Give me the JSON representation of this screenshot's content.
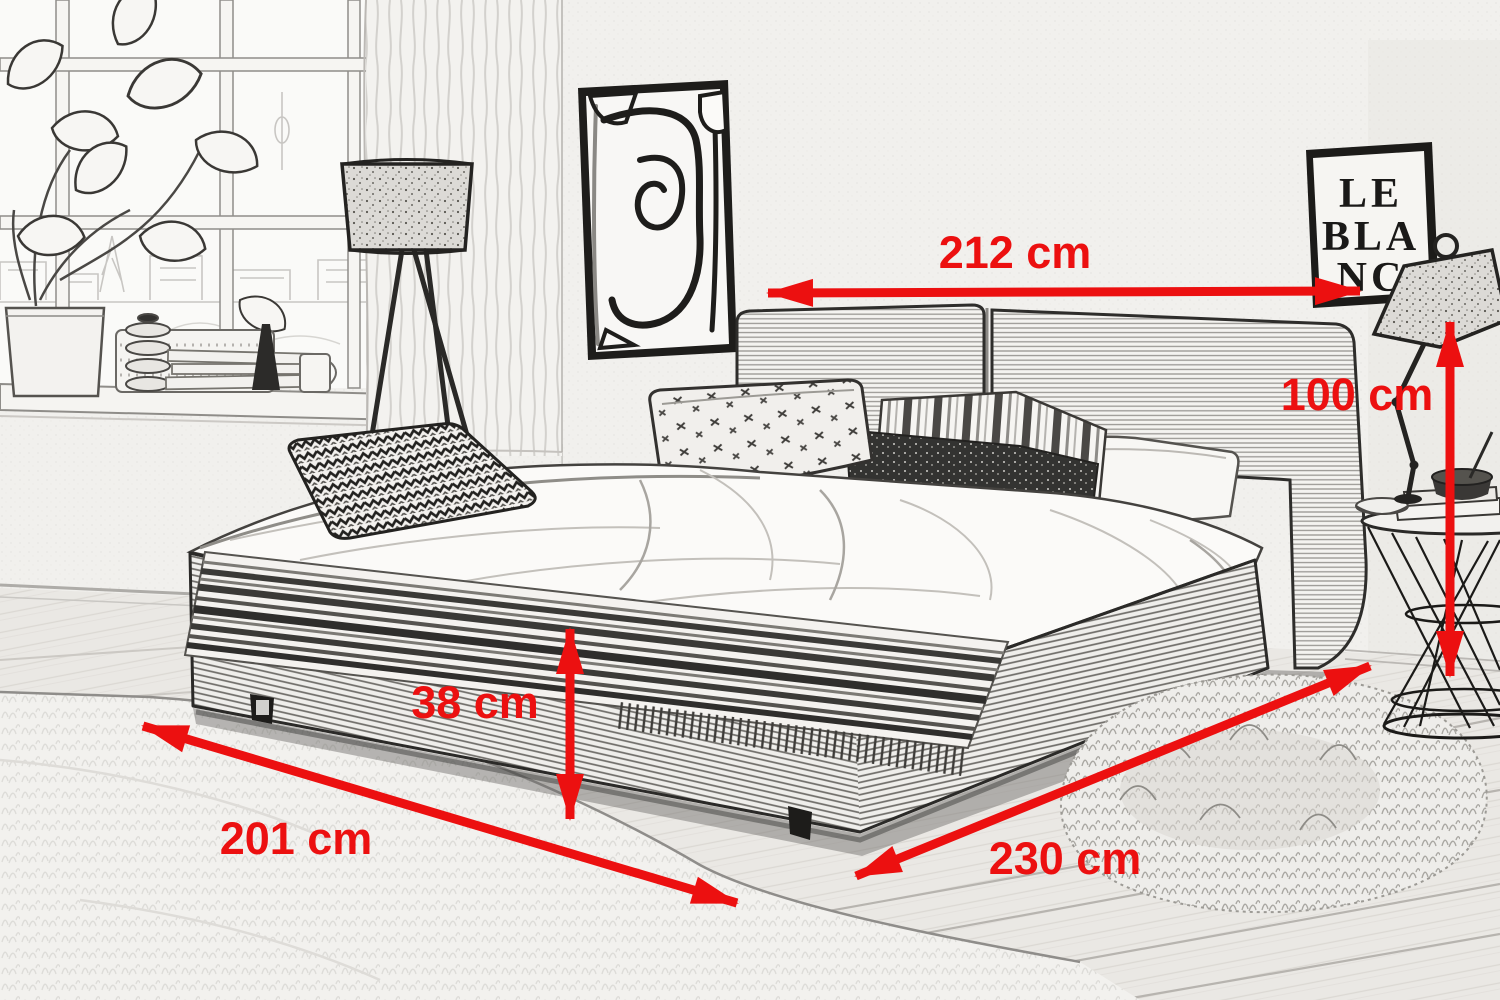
{
  "scene": {
    "poster": {
      "line1": "LE",
      "line2": "BLA",
      "line3": "NC"
    }
  },
  "dimensions": [
    {
      "id": "bed-width-top",
      "label": "212 cm",
      "orientation": "horizontal"
    },
    {
      "id": "headboard-height",
      "label": "100 cm",
      "orientation": "vertical"
    },
    {
      "id": "frame-height",
      "label": "38 cm",
      "orientation": "vertical"
    },
    {
      "id": "bed-length",
      "label": "201 cm",
      "orientation": "diagonal"
    },
    {
      "id": "bed-width-front",
      "label": "230 cm",
      "orientation": "diagonal"
    }
  ],
  "colors": {
    "dimension_red": "#ec1010",
    "sketch_line": "#3c3c3c",
    "wall": "#f1f0ed"
  }
}
